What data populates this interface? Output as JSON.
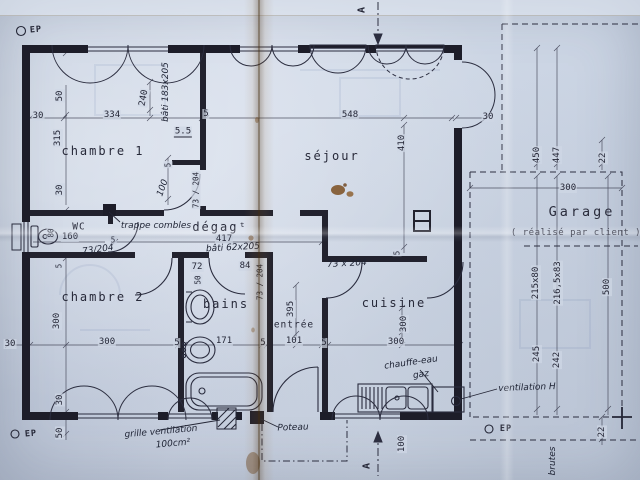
{
  "colors": {
    "paper": "#cdd6e4",
    "ink": "#242636",
    "crease": "#7a5a32",
    "stain": "#7a4e20"
  },
  "rooms": {
    "chambre1": "chambre 1",
    "sejour": "séjour",
    "chambre2": "chambre 2",
    "bains": "bains",
    "entree": "entrée",
    "cuisine": "cuisine",
    "wc": "WC",
    "degagement": "dégagᵗ",
    "garage": "Garage",
    "garage_note": "( réalisé  par client )"
  },
  "labels": [
    {
      "n": "dim-left-offset-top",
      "t": "30",
      "x": 38,
      "y": 116,
      "r": 0,
      "c": "dim"
    },
    {
      "n": "dim-chambre1-width",
      "t": "334",
      "x": 112,
      "y": 115,
      "r": 0,
      "c": "dim"
    },
    {
      "n": "dim-wall-5-top",
      "t": "5",
      "x": 206,
      "y": 114,
      "r": 0,
      "c": "dim"
    },
    {
      "n": "dim-sejour-width",
      "t": "548",
      "x": 350,
      "y": 115,
      "r": 0,
      "c": "dim"
    },
    {
      "n": "dim-right-wall-30",
      "t": "30",
      "x": 488,
      "y": 117,
      "r": 0,
      "c": "dim"
    },
    {
      "n": "dim-window-offset-50",
      "t": "50",
      "x": 60,
      "y": 96,
      "r": -90,
      "c": "dim"
    },
    {
      "n": "dim-chambre1-depth",
      "t": "315",
      "x": 58,
      "y": 138,
      "r": -90,
      "c": "dim"
    },
    {
      "n": "dim-left-30",
      "t": "30",
      "x": 60,
      "y": 190,
      "r": -90,
      "c": "dim"
    },
    {
      "n": "dim-closet-240",
      "t": "240",
      "x": 144,
      "y": 98,
      "r": -80,
      "c": "dim"
    },
    {
      "n": "dim-step-5-5",
      "t": "5.5",
      "x": 183,
      "y": 132,
      "r": 0,
      "c": "dim u"
    },
    {
      "n": "dim-sejour-depth",
      "t": "410",
      "x": 402,
      "y": 143,
      "r": -90,
      "c": "dim"
    },
    {
      "n": "dim-door-offset-5",
      "t": "5",
      "x": 168,
      "y": 165,
      "r": -90,
      "c": "dim small"
    },
    {
      "n": "dim-door-offset-100",
      "t": "100",
      "x": 163,
      "y": 188,
      "r": -70,
      "c": "hand"
    },
    {
      "n": "dim-chambre1-door",
      "t": "73 / 204",
      "x": 196,
      "y": 190,
      "r": -90,
      "c": "dim small"
    },
    {
      "n": "dim-degagement-length",
      "t": "417",
      "x": 224,
      "y": 239,
      "r": 0,
      "c": "dim"
    },
    {
      "n": "dim-wc-width",
      "t": "160",
      "x": 70,
      "y": 237,
      "r": 0,
      "c": "dim"
    },
    {
      "n": "dim-wc-depth",
      "t": "80",
      "x": 51,
      "y": 233,
      "r": -90,
      "c": "dim small"
    },
    {
      "n": "dim-wc-jamb-5",
      "t": "5",
      "x": 113,
      "y": 240,
      "r": 0,
      "c": "dim small"
    },
    {
      "n": "dim-wc-door",
      "t": "73/204",
      "x": 98,
      "y": 250,
      "r": -8,
      "c": "hand small"
    },
    {
      "n": "dim-bains-72",
      "t": "72",
      "x": 197,
      "y": 267,
      "r": 0,
      "c": "dim"
    },
    {
      "n": "dim-bains-50",
      "t": "50",
      "x": 198,
      "y": 280,
      "r": -90,
      "c": "dim small"
    },
    {
      "n": "dim-bains-84",
      "t": "84",
      "x": 245,
      "y": 266,
      "r": 0,
      "c": "dim"
    },
    {
      "n": "dim-bains-door",
      "t": "73 / 204",
      "x": 260,
      "y": 282,
      "r": -90,
      "c": "dim small"
    },
    {
      "n": "dim-mid-left-30",
      "t": "30",
      "x": 10,
      "y": 344,
      "r": 0,
      "c": "dim"
    },
    {
      "n": "dim-chambre2-width",
      "t": "300",
      "x": 107,
      "y": 342,
      "r": 0,
      "c": "dim"
    },
    {
      "n": "dim-wall-5-a",
      "t": "5",
      "x": 177,
      "y": 343,
      "r": 0,
      "c": "dim"
    },
    {
      "n": "dim-bains-width",
      "t": "171",
      "x": 224,
      "y": 341,
      "r": 0,
      "c": "dim"
    },
    {
      "n": "dim-wall-5-b",
      "t": "5",
      "x": 263,
      "y": 343,
      "r": 0,
      "c": "dim"
    },
    {
      "n": "dim-entree-width",
      "t": "101",
      "x": 294,
      "y": 341,
      "r": 0,
      "c": "dim"
    },
    {
      "n": "dim-wall-5-c",
      "t": "5",
      "x": 324,
      "y": 343,
      "r": 0,
      "c": "dim"
    },
    {
      "n": "dim-cuisine-width",
      "t": "300",
      "x": 396,
      "y": 342,
      "r": 0,
      "c": "dim"
    },
    {
      "n": "dim-chambre2-depth",
      "t": "300",
      "x": 57,
      "y": 321,
      "r": -90,
      "c": "dim"
    },
    {
      "n": "dim-chambre2-wall-5",
      "t": "5",
      "x": 59,
      "y": 266,
      "r": -90,
      "c": "dim small"
    },
    {
      "n": "dim-entree-depth",
      "t": "395",
      "x": 291,
      "y": 309,
      "r": -90,
      "c": "dim"
    },
    {
      "n": "dim-cuisine-depth",
      "t": "300",
      "x": 404,
      "y": 324,
      "r": -90,
      "c": "dim"
    },
    {
      "n": "dim-bottom-30",
      "t": "30",
      "x": 60,
      "y": 400,
      "r": -90,
      "c": "dim"
    },
    {
      "n": "dim-bottom-50",
      "t": "50",
      "x": 60,
      "y": 433,
      "r": -90,
      "c": "dim"
    },
    {
      "n": "dim-sejour-wall-5",
      "t": "5",
      "x": 397,
      "y": 253,
      "r": -90,
      "c": "dim small"
    },
    {
      "n": "dim-porch-100",
      "t": "100",
      "x": 402,
      "y": 444,
      "r": -90,
      "c": "dim"
    },
    {
      "n": "dim-garage-450",
      "t": "450",
      "x": 537,
      "y": 155,
      "r": -90,
      "c": "dim"
    },
    {
      "n": "dim-garage-447",
      "t": "447",
      "x": 557,
      "y": 155,
      "r": -90,
      "c": "dim"
    },
    {
      "n": "dim-garage-22-top",
      "t": "22",
      "x": 603,
      "y": 158,
      "r": -90,
      "c": "dim"
    },
    {
      "n": "dim-garage-width",
      "t": "300",
      "x": 568,
      "y": 188,
      "r": 0,
      "c": "dim"
    },
    {
      "n": "dim-garage-depth",
      "t": "500",
      "x": 607,
      "y": 287,
      "r": -90,
      "c": "dim"
    },
    {
      "n": "dim-garage-door-215x80",
      "t": "215x80",
      "x": 536,
      "y": 283,
      "r": -90,
      "c": "dim"
    },
    {
      "n": "dim-garage-door-216x83",
      "t": "216,5x83",
      "x": 558,
      "y": 283,
      "r": -90,
      "c": "dim"
    },
    {
      "n": "dim-garage-245",
      "t": "245",
      "x": 537,
      "y": 354,
      "r": -90,
      "c": "dim"
    },
    {
      "n": "dim-garage-242",
      "t": "242",
      "x": 557,
      "y": 360,
      "r": -90,
      "c": "dim"
    },
    {
      "n": "dim-garage-22-bottom",
      "t": "22",
      "x": 602,
      "y": 432,
      "r": -90,
      "c": "dim"
    },
    {
      "n": "room-label-chambre1",
      "t": "chambre 1",
      "x": 103,
      "y": 151,
      "r": 0,
      "c": "room"
    },
    {
      "n": "room-label-sejour",
      "t": "séjour",
      "x": 332,
      "y": 156,
      "r": 0,
      "c": "room"
    },
    {
      "n": "room-label-chambre2",
      "t": "chambre 2",
      "x": 103,
      "y": 297,
      "r": 0,
      "c": "room"
    },
    {
      "n": "room-label-bains",
      "t": "bains",
      "x": 226,
      "y": 304,
      "r": 0,
      "c": "room"
    },
    {
      "n": "room-label-entree",
      "t": "entrée",
      "x": 294,
      "y": 325,
      "r": 0,
      "c": "room small-room"
    },
    {
      "n": "room-label-cuisine",
      "t": "cuisine",
      "x": 394,
      "y": 303,
      "r": 0,
      "c": "room"
    },
    {
      "n": "room-label-wc",
      "t": "WC",
      "x": 79,
      "y": 227,
      "r": 0,
      "c": "room small-room"
    },
    {
      "n": "room-label-degagement",
      "t": "dégagᵗ",
      "x": 220,
      "y": 227,
      "r": 0,
      "c": "room"
    },
    {
      "n": "room-label-garage",
      "t": "Garage",
      "x": 582,
      "y": 212,
      "r": 0,
      "c": "garage-title"
    },
    {
      "n": "garage-note",
      "t": "( réalisé  par client )",
      "x": 576,
      "y": 233,
      "r": 0,
      "c": "gsmall"
    },
    {
      "n": "note-ep-top-left",
      "t": "EP",
      "x": 36,
      "y": 30,
      "r": -5,
      "c": "ep"
    },
    {
      "n": "note-bati-183x205",
      "t": "bâti 183x205",
      "x": 166,
      "y": 92,
      "r": -90,
      "c": "hand"
    },
    {
      "n": "note-trappe-combles",
      "t": "trappe combles",
      "x": 156,
      "y": 226,
      "r": 0,
      "c": "hand"
    },
    {
      "n": "note-bati-62x205",
      "t": "bâti 62x205",
      "x": 233,
      "y": 248,
      "r": -3,
      "c": "hand"
    },
    {
      "n": "note-73x204-cuisine",
      "t": "73 x 204",
      "x": 347,
      "y": 264,
      "r": -3,
      "c": "hand"
    },
    {
      "n": "note-chauffe-eau",
      "t": "chauffe-eau",
      "x": 411,
      "y": 363,
      "r": -8,
      "c": "hand"
    },
    {
      "n": "note-gaz",
      "t": "gaz",
      "x": 421,
      "y": 375,
      "r": -8,
      "c": "hand"
    },
    {
      "n": "note-ventilation-h",
      "t": "ventilation H",
      "x": 527,
      "y": 388,
      "r": -2,
      "c": "hand"
    },
    {
      "n": "note-grille-ventilation",
      "t": "grille ventilation",
      "x": 161,
      "y": 432,
      "r": -5,
      "c": "hand"
    },
    {
      "n": "note-100cm2",
      "t": "100cm²",
      "x": 173,
      "y": 444,
      "r": -5,
      "c": "hand"
    },
    {
      "n": "note-poteau",
      "t": "Poteau",
      "x": 293,
      "y": 428,
      "r": -2,
      "c": "hand"
    },
    {
      "n": "note-brutes",
      "t": "brutes",
      "x": 553,
      "y": 461,
      "r": -90,
      "c": "hand"
    },
    {
      "n": "note-ep-bottom-right",
      "t": "EP",
      "x": 506,
      "y": 429,
      "r": 0,
      "c": "ep"
    },
    {
      "n": "note-ep-bottom-left",
      "t": "EP",
      "x": 31,
      "y": 434,
      "r": -5,
      "c": "ep"
    },
    {
      "n": "section-marker-a-top",
      "t": "A",
      "x": 362,
      "y": 10,
      "r": -90,
      "c": "sect"
    },
    {
      "n": "section-marker-a-bottom",
      "t": "A",
      "x": 367,
      "y": 466,
      "r": -90,
      "c": "sect"
    }
  ]
}
